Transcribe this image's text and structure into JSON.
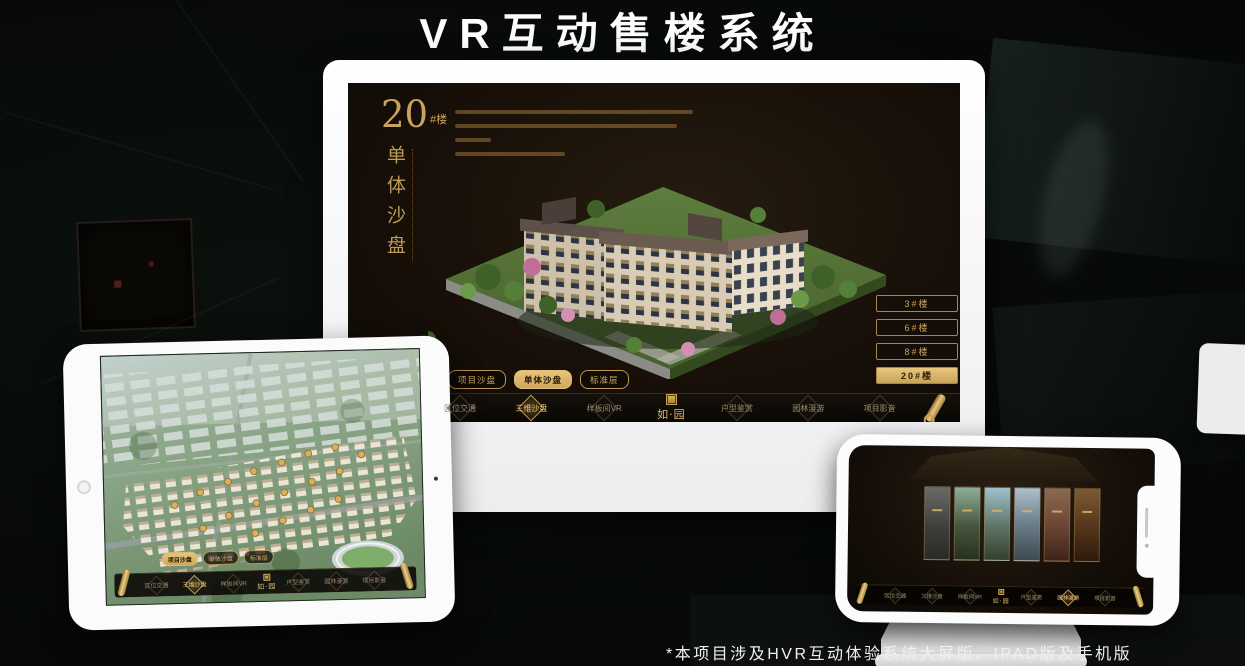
{
  "page": {
    "title": "VR互动售楼系统",
    "footnote": "*本项目涉及HVR互动体验系统大屏版、IPAD版及手机版"
  },
  "colors": {
    "gold_accent": "#c9a25f",
    "gold_active_bg": "#d9b468",
    "screen_bg": "#16100a",
    "device_white": "#fbfbfc"
  },
  "app": {
    "section": {
      "number": "20",
      "unit": "#楼",
      "subtitle": "单体沙盘"
    },
    "floor_buttons": [
      {
        "label": "3#楼",
        "selected": false
      },
      {
        "label": "6#楼",
        "selected": false
      },
      {
        "label": "8#楼",
        "selected": false
      },
      {
        "label": "20#楼",
        "selected": true
      }
    ],
    "sub_tabs": [
      {
        "label": "项目沙盘"
      },
      {
        "label": "单体沙盘"
      },
      {
        "label": "标准层"
      }
    ],
    "monitor_active_sub_tab": "单体沙盘",
    "ipad_active_sub_tab": "项目沙盘",
    "nav": {
      "items": [
        {
          "label": "区位交通"
        },
        {
          "label": "三维沙盘"
        },
        {
          "label": "样板间VR"
        },
        {
          "label": "户型鉴赏"
        },
        {
          "label": "园林漫游"
        },
        {
          "label": "项目影音"
        }
      ],
      "logo": "如·园",
      "monitor_active": "三维沙盘",
      "ipad_active": "三维沙盘",
      "phone_active": "园林漫游"
    }
  }
}
